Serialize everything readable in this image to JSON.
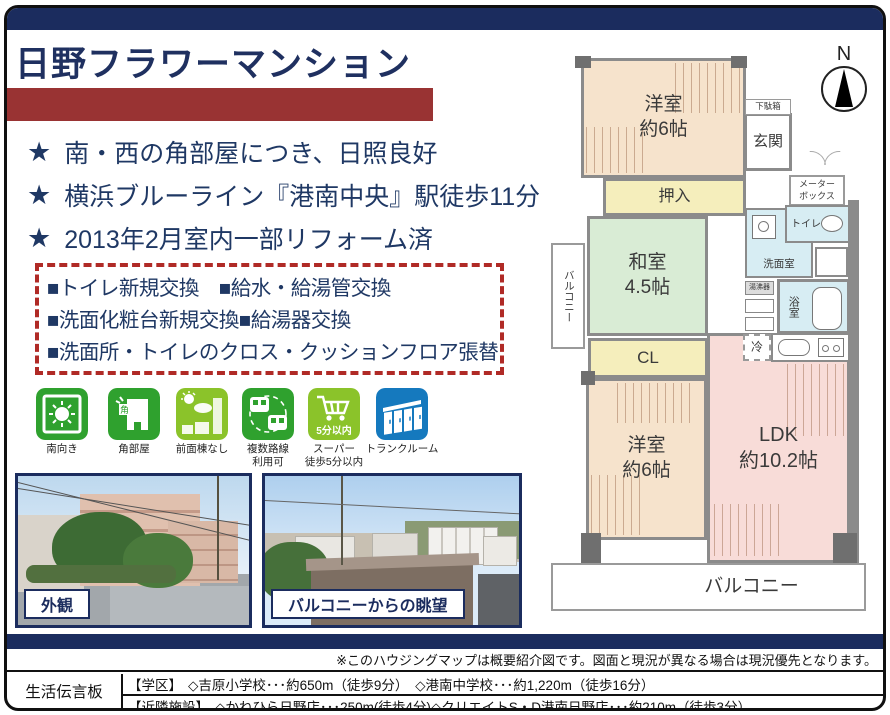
{
  "colors": {
    "navy": "#1b2c5e",
    "brick": "#993333",
    "dash_red": "#b02a26",
    "text_navy": "#1f3864",
    "icon_green": "#2fa12e",
    "icon_light_green": "#8bc32a",
    "icon_blue": "#1579be"
  },
  "header": {
    "title": "日野フラワーマンション"
  },
  "highlights": {
    "star": "★",
    "items": [
      "南・西の角部屋につき、日照良好",
      "横浜ブルーライン『港南中央』駅徒歩11分",
      "2013年2月室内一部リフォーム済"
    ]
  },
  "renovations": {
    "lines": [
      "■トイレ新規交換　■給水・給湯管交換",
      "■洗面化粧台新規交換■給湯器交換",
      "■洗面所・トイレのクロス・クッションフロア張替"
    ]
  },
  "features": [
    {
      "label": "南向き"
    },
    {
      "label": "角部屋",
      "tag": "角"
    },
    {
      "label": "前面棟なし"
    },
    {
      "label": "複数路線\n利用可"
    },
    {
      "label": "スーパー\n徒歩5分以内",
      "badge": "5分以内"
    },
    {
      "label": "トランクルーム"
    }
  ],
  "photos": {
    "left_caption": "外観",
    "right_caption": "バルコニーからの眺望"
  },
  "floorplan": {
    "compass": "N",
    "rooms": {
      "west1": "洋室\n約6帖",
      "getabako": "下駄箱",
      "genkan": "玄関",
      "meterbox": "メーター\nボックス",
      "oshiire": "押入",
      "washitsu": "和室\n4.5帖",
      "balcony_left": "バルコニー",
      "cl": "CL",
      "west2": "洋室\n約6帖",
      "ldk": "LDK\n約10.2帖",
      "toilet": "トイレ",
      "senmen": "洗面室",
      "bath": "浴室",
      "heater": "湯沸器",
      "fridge": "冷",
      "balcony_bottom": "バルコニー"
    }
  },
  "footer": {
    "note": "※このハウジングマップは概要紹介図です。図面と現況が異なる場合は現況優先となります。",
    "board_title": "生活伝言板",
    "rows": [
      {
        "label": "【学区】",
        "text": "◇吉原小学校･･･約650m（徒歩9分）　◇港南中学校･･･約1,220m（徒歩16分）"
      },
      {
        "label": "【近隣施設】",
        "text": "◇かねひら日野店･･･250m(徒歩4分)◇クリエイトS・D港南日野店･･･約210m（徒歩3分）"
      }
    ]
  }
}
